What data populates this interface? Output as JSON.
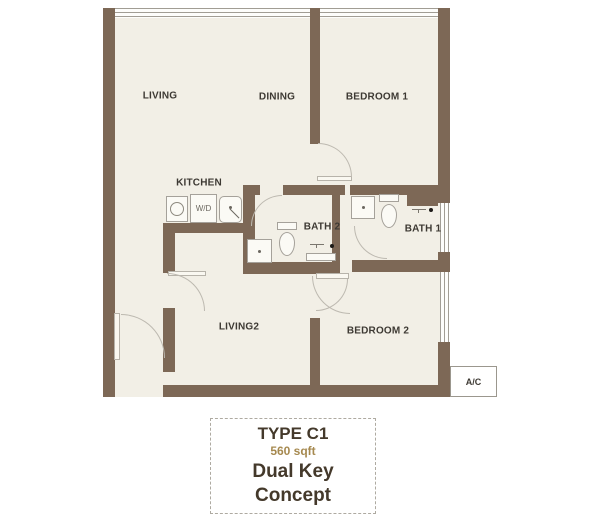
{
  "plan": {
    "rooms": [
      {
        "name": "living",
        "label": "LIVING"
      },
      {
        "name": "dining",
        "label": "DINING"
      },
      {
        "name": "bedroom1",
        "label": "BEDROOM 1"
      },
      {
        "name": "kitchen",
        "label": "KITCHEN"
      },
      {
        "name": "bath2",
        "label": "BATH 2"
      },
      {
        "name": "bath1",
        "label": "BATH 1"
      },
      {
        "name": "living2",
        "label": "LIVING2"
      },
      {
        "name": "bedroom2",
        "label": "BEDROOM 2"
      }
    ],
    "fixtures": {
      "washer_dryer_label": "W/D"
    },
    "ac_label": "A/C",
    "colors": {
      "wall": "#7d6856",
      "floor": "#f2efe6",
      "fixture_outline": "#a5a19a",
      "door_arc": "#bdb9b0"
    }
  },
  "title_block": {
    "type_label": "TYPE C1",
    "area_label": "560 sqft",
    "concept_label": "Dual Key Concept"
  }
}
